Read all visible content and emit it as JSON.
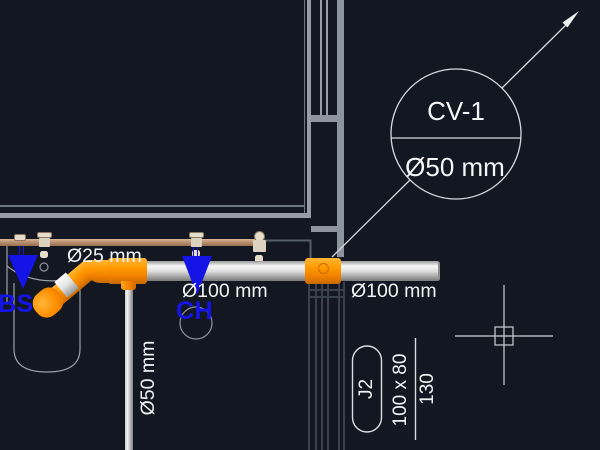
{
  "drawing": {
    "pipe_labels": {
      "supply_diameter": "Ø25 mm",
      "waste_left_diameter": "Ø100 mm",
      "waste_right_diameter": "Ø100 mm",
      "vertical_diameter": "Ø50 mm"
    },
    "fixture_symbols": {
      "bs": "BS",
      "ch": "CH"
    },
    "callout": {
      "tag": "CV-1",
      "size": "Ø50 mm"
    },
    "duct_tag": {
      "name": "J2",
      "dimensions": "100 x 80",
      "value": "130"
    },
    "colors": {
      "background": "#121722",
      "wall_bright": "#969da7",
      "wall_dim": "#39424c",
      "fitting_orange": "#ff9a00",
      "symbol_blue": "#1414e6",
      "supply_pipe_tan": "#bb9070",
      "line_white": "#d6dade"
    }
  }
}
